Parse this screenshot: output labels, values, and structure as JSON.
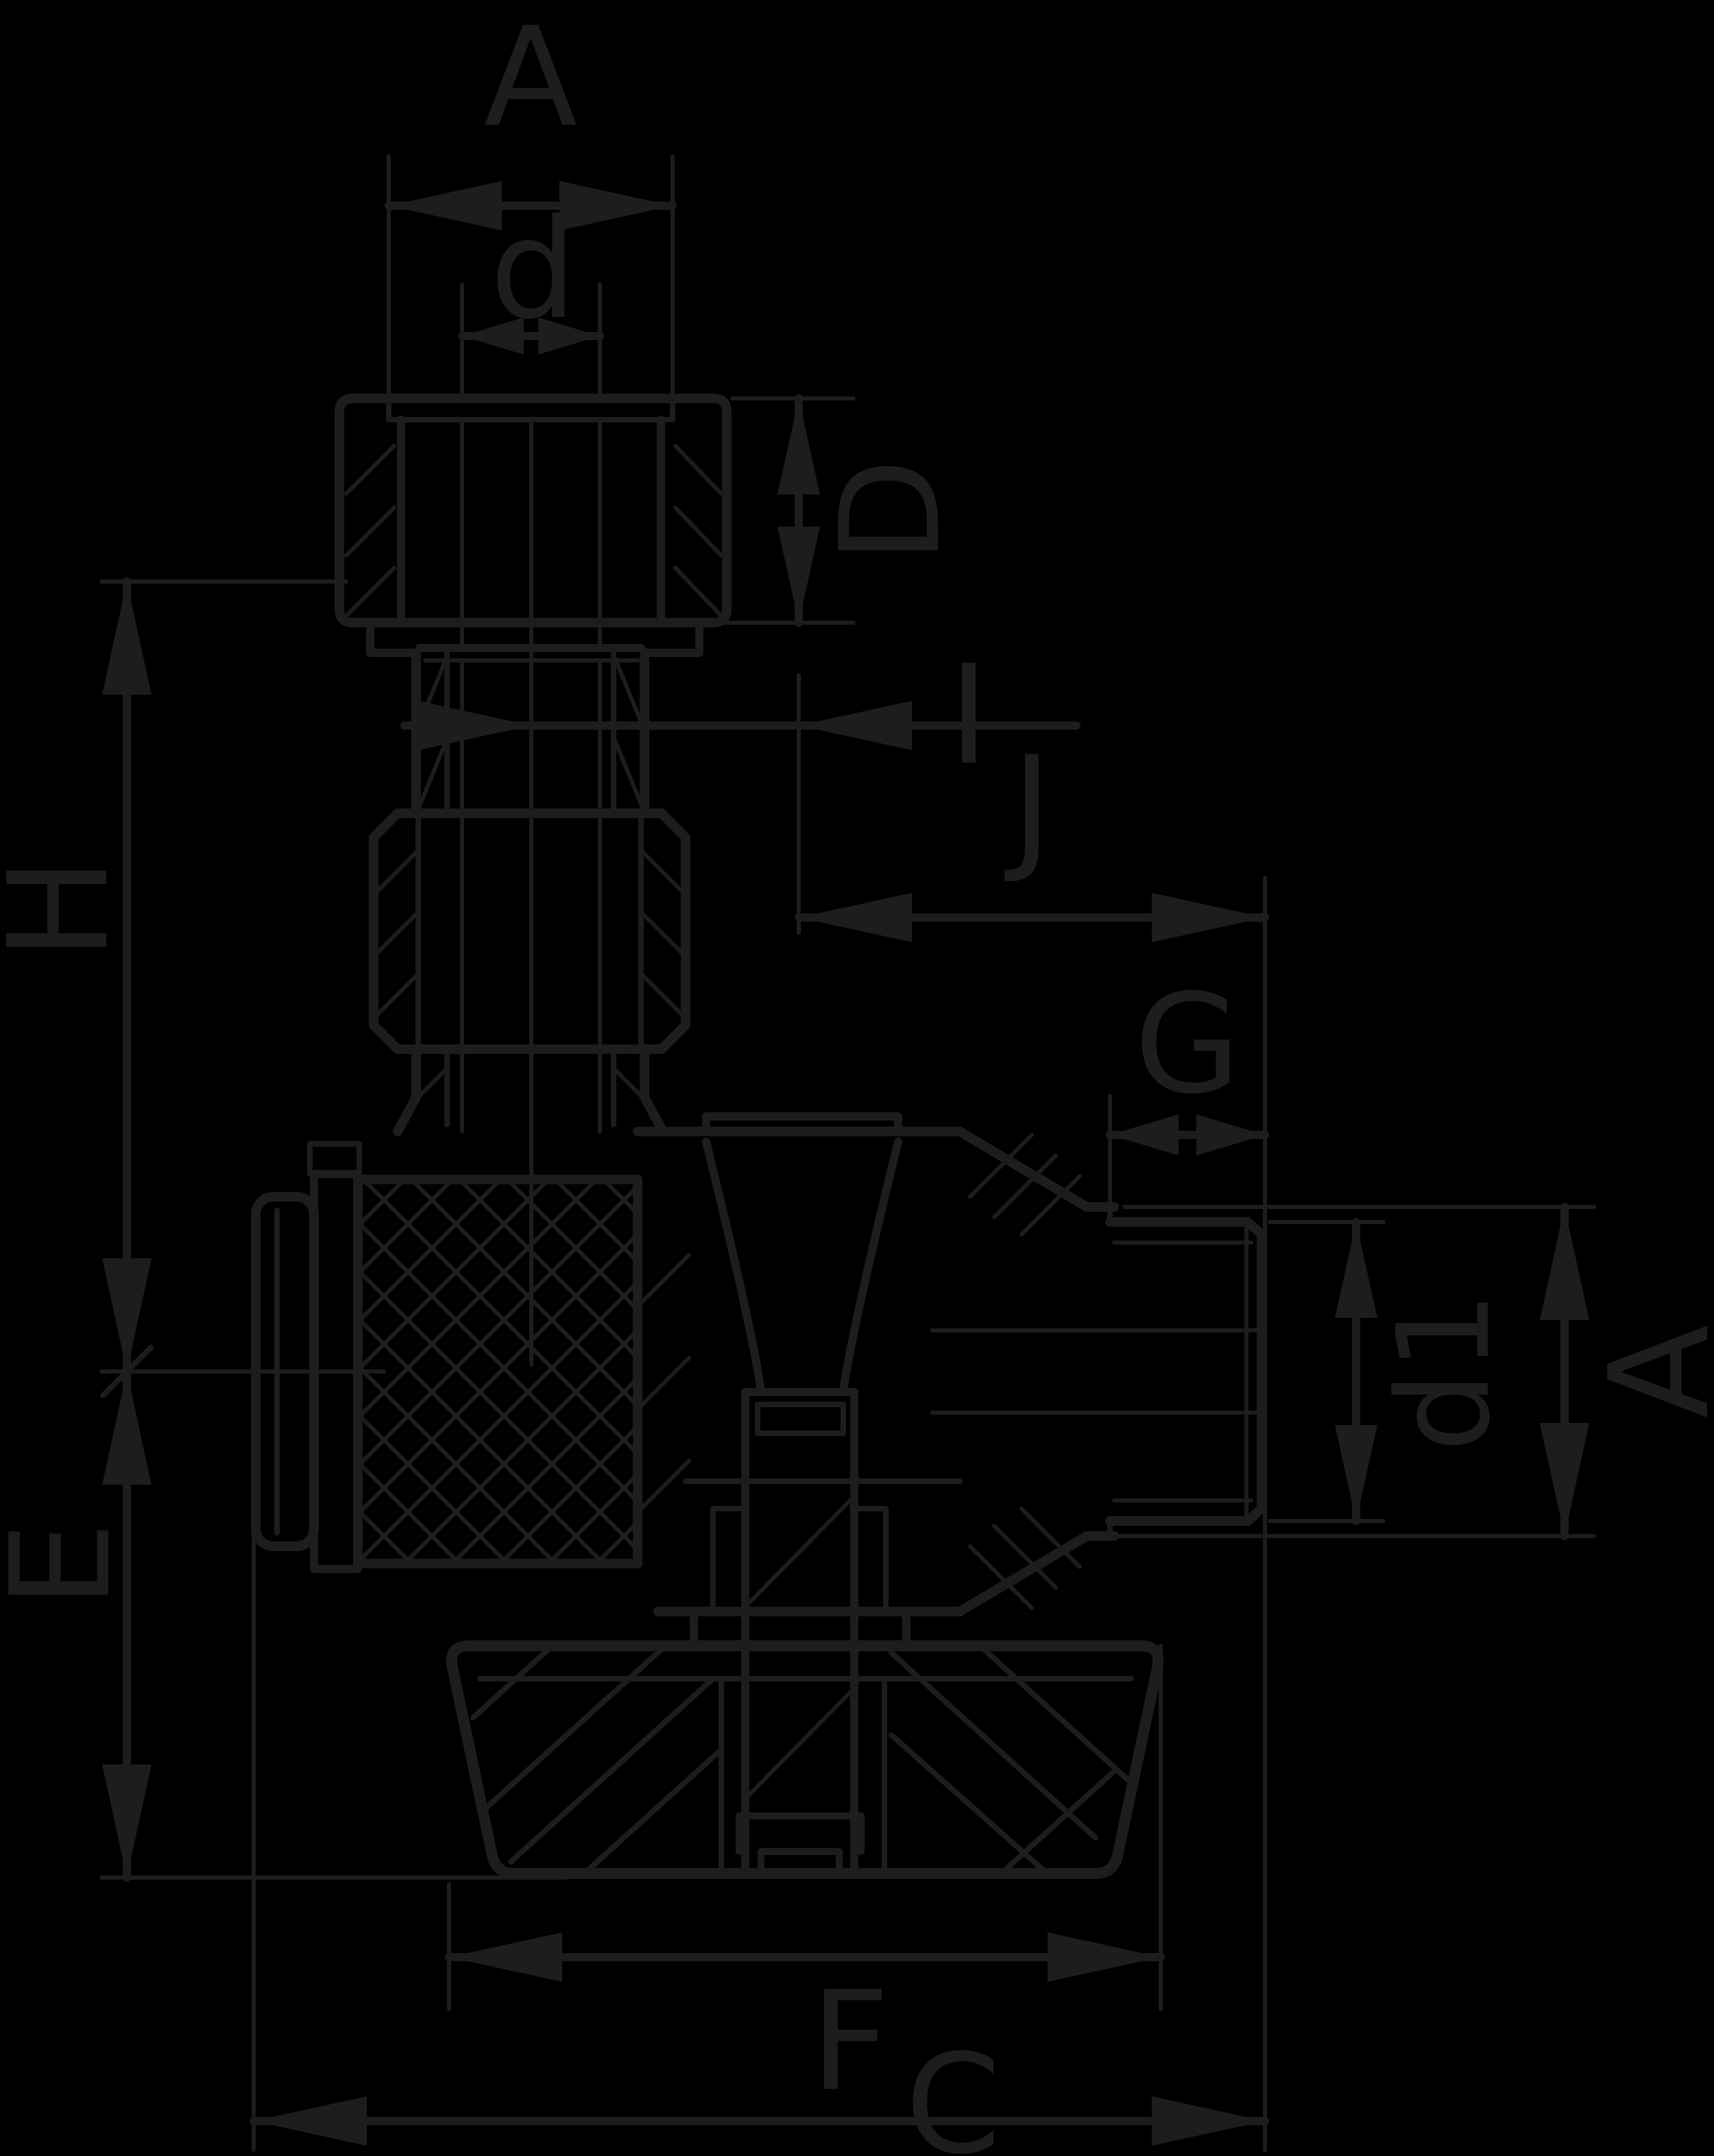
{
  "drawing_title": "valve-cross-section-dimension-drawing",
  "colors": {
    "background": "#000000",
    "ink": "#1d1d1b"
  },
  "labels": {
    "width_across_flats_top": "A",
    "tube_diameter": "d",
    "nut_height": "D",
    "height_above_center": "H",
    "axis_offset": "I",
    "center_to_port_end": "J",
    "thread_length": "G",
    "thread_diameter": "d1",
    "width_across_flats_side": "A",
    "center_to_handle_bottom": "E",
    "handle_width": "F",
    "overall_length": "C"
  }
}
